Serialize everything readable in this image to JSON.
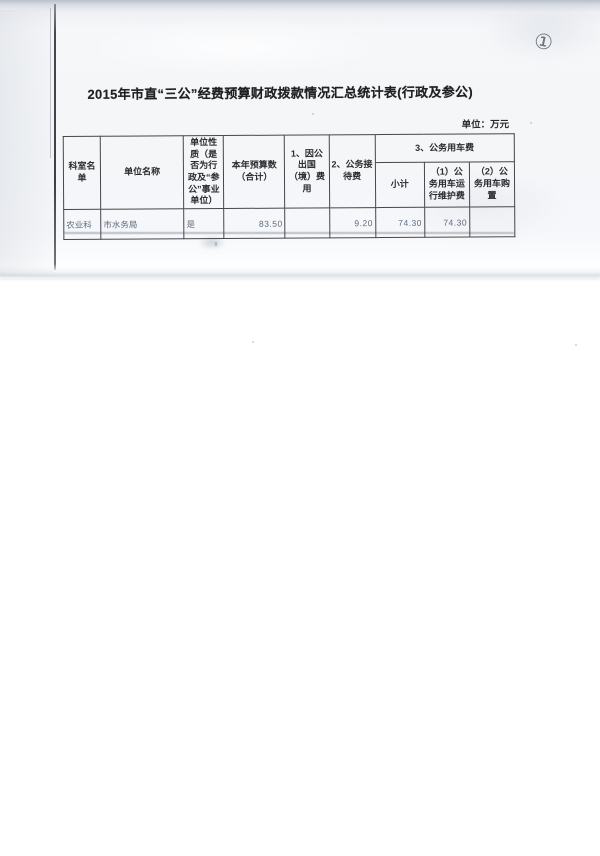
{
  "annotations": {
    "page_number": "①"
  },
  "document": {
    "title": "2015年市直“三公”经费预算财政拨款情况汇总统计表(行政及参公)",
    "unit_note": "单位：万元"
  },
  "table": {
    "header": {
      "dept_list": "科室名单",
      "unit_name": "单位名称",
      "unit_nature": "单位性质（是否为行政及“参公”事业单位）",
      "annual_budget_total": "本年预算数（合计）",
      "overseas_expense": "1、因公出国（境）费用",
      "reception_expense": "2、公务接待费",
      "vehicle_group": "3、公务用车费",
      "vehicle_subtotal": "小计",
      "vehicle_maintenance": "（1）公务用车运行维护费",
      "vehicle_purchase": "（2）公务用车购置"
    },
    "rows": [
      {
        "dept": "农业科",
        "unit_name": "市水务局",
        "unit_nature": "是",
        "annual_budget_total": "83.50",
        "overseas_expense": "",
        "reception_expense": "9.20",
        "vehicle_subtotal": "74.30",
        "vehicle_maintenance": "74.30",
        "vehicle_purchase": ""
      }
    ]
  }
}
